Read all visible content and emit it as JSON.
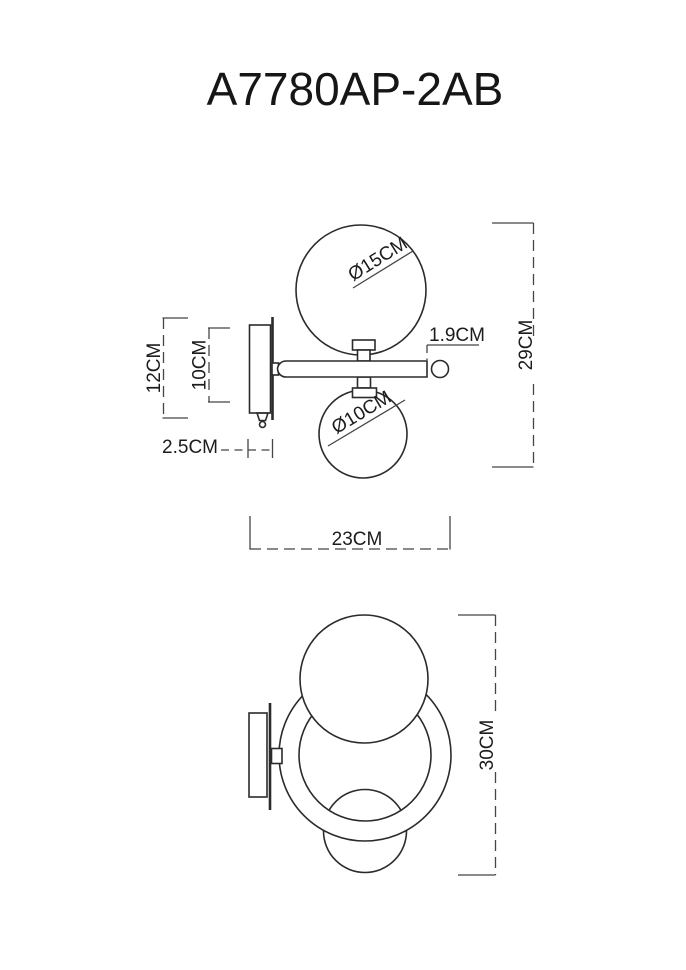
{
  "title": "A7780AP-2AB",
  "colors": {
    "line": "#2b2b2b",
    "dimension_line": "#454545",
    "text": "#1c1c1c",
    "background": "#ffffff"
  },
  "side_view": {
    "dimensions": {
      "upper_globe_diameter": "Ø15CM",
      "lower_globe_diameter": "Ø10CM",
      "arm_tube_diameter": "1.9CM",
      "overall_height": "29CM",
      "wall_mount_height": "12CM",
      "backplate_height": "10CM",
      "backplate_depth": "2.5CM",
      "overall_projection": "23CM"
    }
  },
  "front_view": {
    "dimensions": {
      "overall_height": "30CM"
    }
  }
}
